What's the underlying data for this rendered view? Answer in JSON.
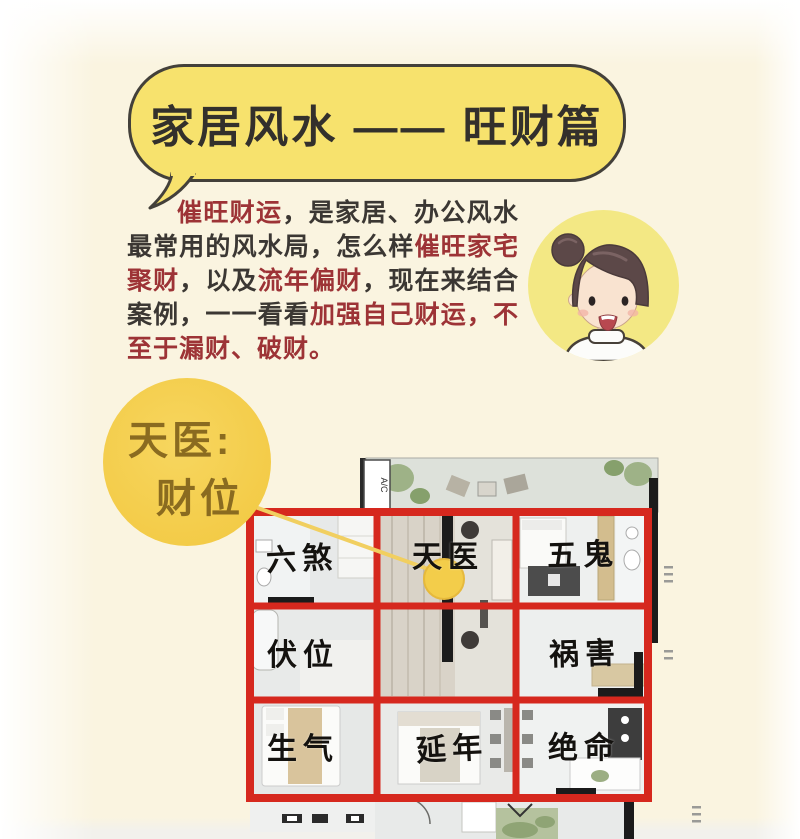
{
  "header": {
    "title": "家居风水 —— 旺财篇"
  },
  "intro": {
    "segments": [
      {
        "text": "催旺财运",
        "tone": "red"
      },
      {
        "text": "，是家居、办公风水最常用的风水局，怎么样",
        "tone": "dark"
      },
      {
        "text": "催旺家宅聚财",
        "tone": "red"
      },
      {
        "text": "，以及",
        "tone": "dark"
      },
      {
        "text": "流年偏财",
        "tone": "red"
      },
      {
        "text": "，现在来结合案例，一一看看",
        "tone": "dark"
      },
      {
        "text": "加强自己财运，不至于漏财、破财。",
        "tone": "red"
      }
    ]
  },
  "badge": {
    "line1": "天医:",
    "line2": "财位"
  },
  "avatar": {
    "icon": "woman-with-hair-bun-avatar"
  },
  "floor_plan": {
    "ac_label": "A/C",
    "cells": [
      {
        "label": "六煞"
      },
      {
        "label": "天医"
      },
      {
        "label": "五鬼"
      },
      {
        "label": "伏位"
      },
      {
        "label": "祸害"
      },
      {
        "label": "生气"
      },
      {
        "label": "延年"
      },
      {
        "label": "绝命"
      }
    ]
  },
  "colors": {
    "bubble_yellow": "#f7e26d",
    "badge_yellow": "#f3cb47",
    "avatar_yellow": "#f3e884",
    "grid_red": "#d6281e",
    "accent_text_red": "#9d3336",
    "body_text_dark": "#3b3733"
  }
}
